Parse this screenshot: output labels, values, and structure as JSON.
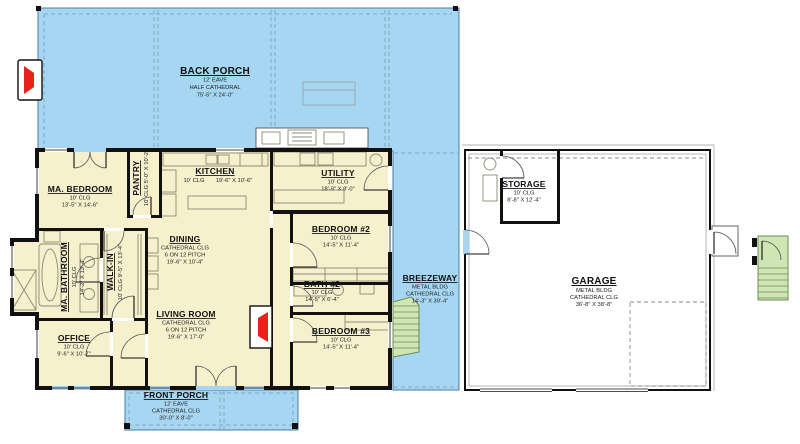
{
  "colors": {
    "porch": "#a6d6f1",
    "house": "#f7f0cd",
    "garage": "#ffffff",
    "wall": "#111111",
    "stairs_fill": "#cfe5b4",
    "stairs_stroke": "#6b8d53",
    "fireplace": "#e8211a",
    "dashed": "#7fa8c4",
    "fixture": "#8a8a74"
  },
  "rooms": {
    "back_porch": {
      "name": "BACK PORCH",
      "l1": "12' EAVE",
      "l2": "HALF CATHEDRAL",
      "l3": "75'-5\" X 24'-0\""
    },
    "front_porch": {
      "name": "FRONT PORCH",
      "l1": "12' EAVE",
      "l2": "CATHEDRAL CLG",
      "l3": "30'-0\" X 8'-0\""
    },
    "breezeway": {
      "name": "BREEZEWAY",
      "l1": "METAL BLDG",
      "l2": "CATHEDRAL CLG",
      "l3": "14'-3\" X 39'-4\""
    },
    "garage": {
      "name": "GARAGE",
      "l1": "METAL BLDG",
      "l2": "CATHEDRAL CLG",
      "l3": "36'-8\" X 38'-8\""
    },
    "storage": {
      "name": "STORAGE",
      "l1": "10' CLG",
      "l2": "8'-8\" X 12'-4\""
    },
    "ma_bedroom": {
      "name": "MA. BEDROOM",
      "l1": "10' CLG",
      "l2": "13'-5\" X 14'-6\""
    },
    "pantry": {
      "name": "PANTRY",
      "l1": "10' CLG  5'-0\" X 10'-2\""
    },
    "kitchen": {
      "name": "KITCHEN",
      "l1": "10' CLG",
      "l2": "19'-6\" X 10'-6\""
    },
    "utility": {
      "name": "UTILITY",
      "l1": "10' CLG",
      "l2": "18'-9\" X 8'-0\""
    },
    "ma_bathroom": {
      "name": "MA. BATHROOM",
      "l1": "10' CLG",
      "l2": "14'-2\" X 13'-4\""
    },
    "walk_in": {
      "name": "WALK-IN",
      "l1": "10' CLG  9'-5\" X 13'-4\""
    },
    "dining": {
      "name": "DINING",
      "l1": "CATHEDRAL CLG",
      "l2": "6 ON 12 PITCH",
      "l3": "19'-6\" X 10'-4\""
    },
    "living_room": {
      "name": "LIVING ROOM",
      "l1": "CATHEDRAL CLG",
      "l2": "6 ON 12 PITCH",
      "l3": "19'-6\" X 17'-0\""
    },
    "office": {
      "name": "OFFICE",
      "l1": "10' CLG",
      "l2": "9'-6\" X 10'-7\""
    },
    "bedroom_2": {
      "name": "BEDROOM #2",
      "l1": "10' CLG",
      "l2": "14'-5\" X 11'-4\""
    },
    "bath_2": {
      "name": "BATH #2",
      "l1": "10' CLG",
      "l2": "14'-5\" X 6'-4\""
    },
    "bedroom_3": {
      "name": "BEDROOM #3",
      "l1": "10' CLG",
      "l2": "14'-5\" X 11'-4\""
    }
  }
}
